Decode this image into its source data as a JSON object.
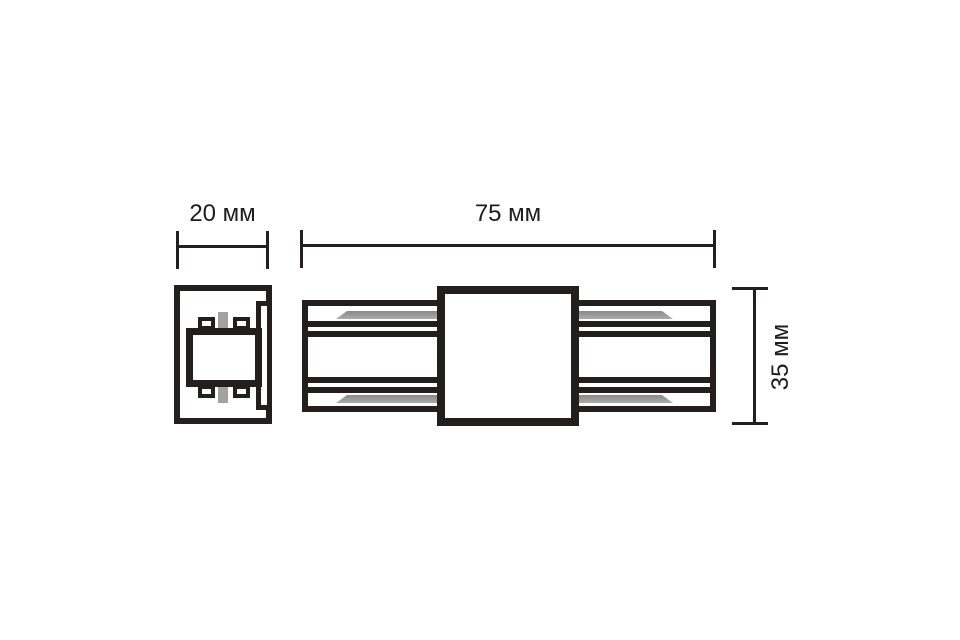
{
  "drawing": {
    "type": "technical-dimension-drawing",
    "subject": "track-connector-two-views",
    "dimensions": {
      "end_width": {
        "label": "20 мм",
        "value_mm": 20,
        "orientation": "horizontal",
        "applies_to": "end-view"
      },
      "length": {
        "label": "75 мм",
        "value_mm": 75,
        "orientation": "horizontal",
        "applies_to": "side-view"
      },
      "height": {
        "label": "35 мм",
        "value_mm": 35,
        "orientation": "vertical",
        "applies_to": "side-view"
      }
    },
    "colors": {
      "line": "#231f1e",
      "conductor_gray": "#9e9e9e",
      "background": "#ffffff",
      "text": "#1d1d1d"
    }
  }
}
